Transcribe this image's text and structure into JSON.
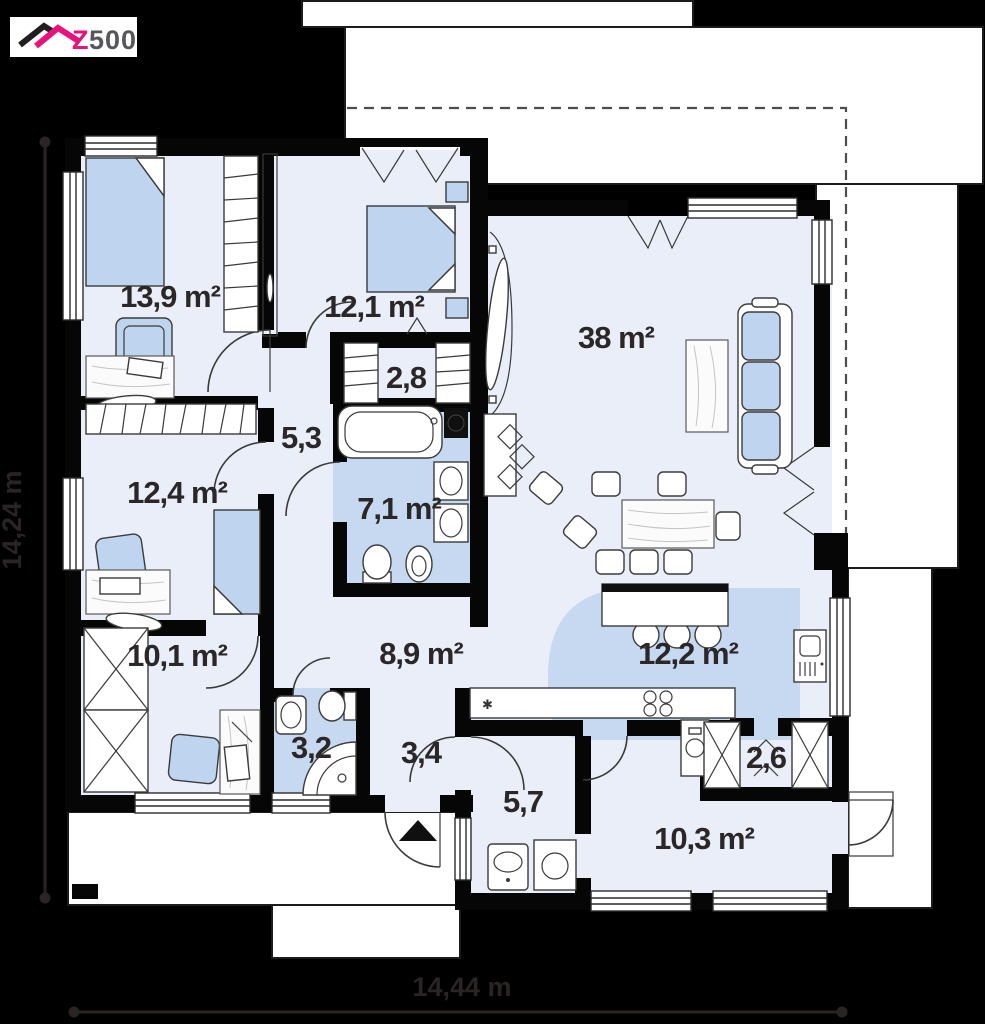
{
  "logo": {
    "z": "Z",
    "rest": "500"
  },
  "dimensions": {
    "width": "14,44 m",
    "height": "14,24 m"
  },
  "kitchen": {
    "counter_marker": "✱"
  },
  "rooms": [
    {
      "id": "bedroom-1",
      "area": "13,9 m²"
    },
    {
      "id": "bedroom-2",
      "area": "12,1 m²"
    },
    {
      "id": "wardrobe",
      "area": "2,8"
    },
    {
      "id": "hall",
      "area": "5,3"
    },
    {
      "id": "bedroom-3",
      "area": "12,4 m²"
    },
    {
      "id": "bathroom",
      "area": "7,1 m²"
    },
    {
      "id": "living-room",
      "area": "38 m²"
    },
    {
      "id": "office",
      "area": "10,1 m²"
    },
    {
      "id": "corridor",
      "area": "8,9 m²"
    },
    {
      "id": "kitchen",
      "area": "12,2 m²"
    },
    {
      "id": "shower-room",
      "area": "3,2"
    },
    {
      "id": "entry-hall",
      "area": "3,4"
    },
    {
      "id": "utility-room",
      "area": "5,7"
    },
    {
      "id": "pantry",
      "area": "2,6"
    },
    {
      "id": "storage-room",
      "area": "10,3 m²"
    }
  ],
  "colors": {
    "floor": "#e9eef8",
    "wet_zone": "#c6d9f1",
    "furniture": "#bed4ef",
    "wall": "#060606",
    "brand_pink": "#e6127d",
    "background": "#000000"
  }
}
